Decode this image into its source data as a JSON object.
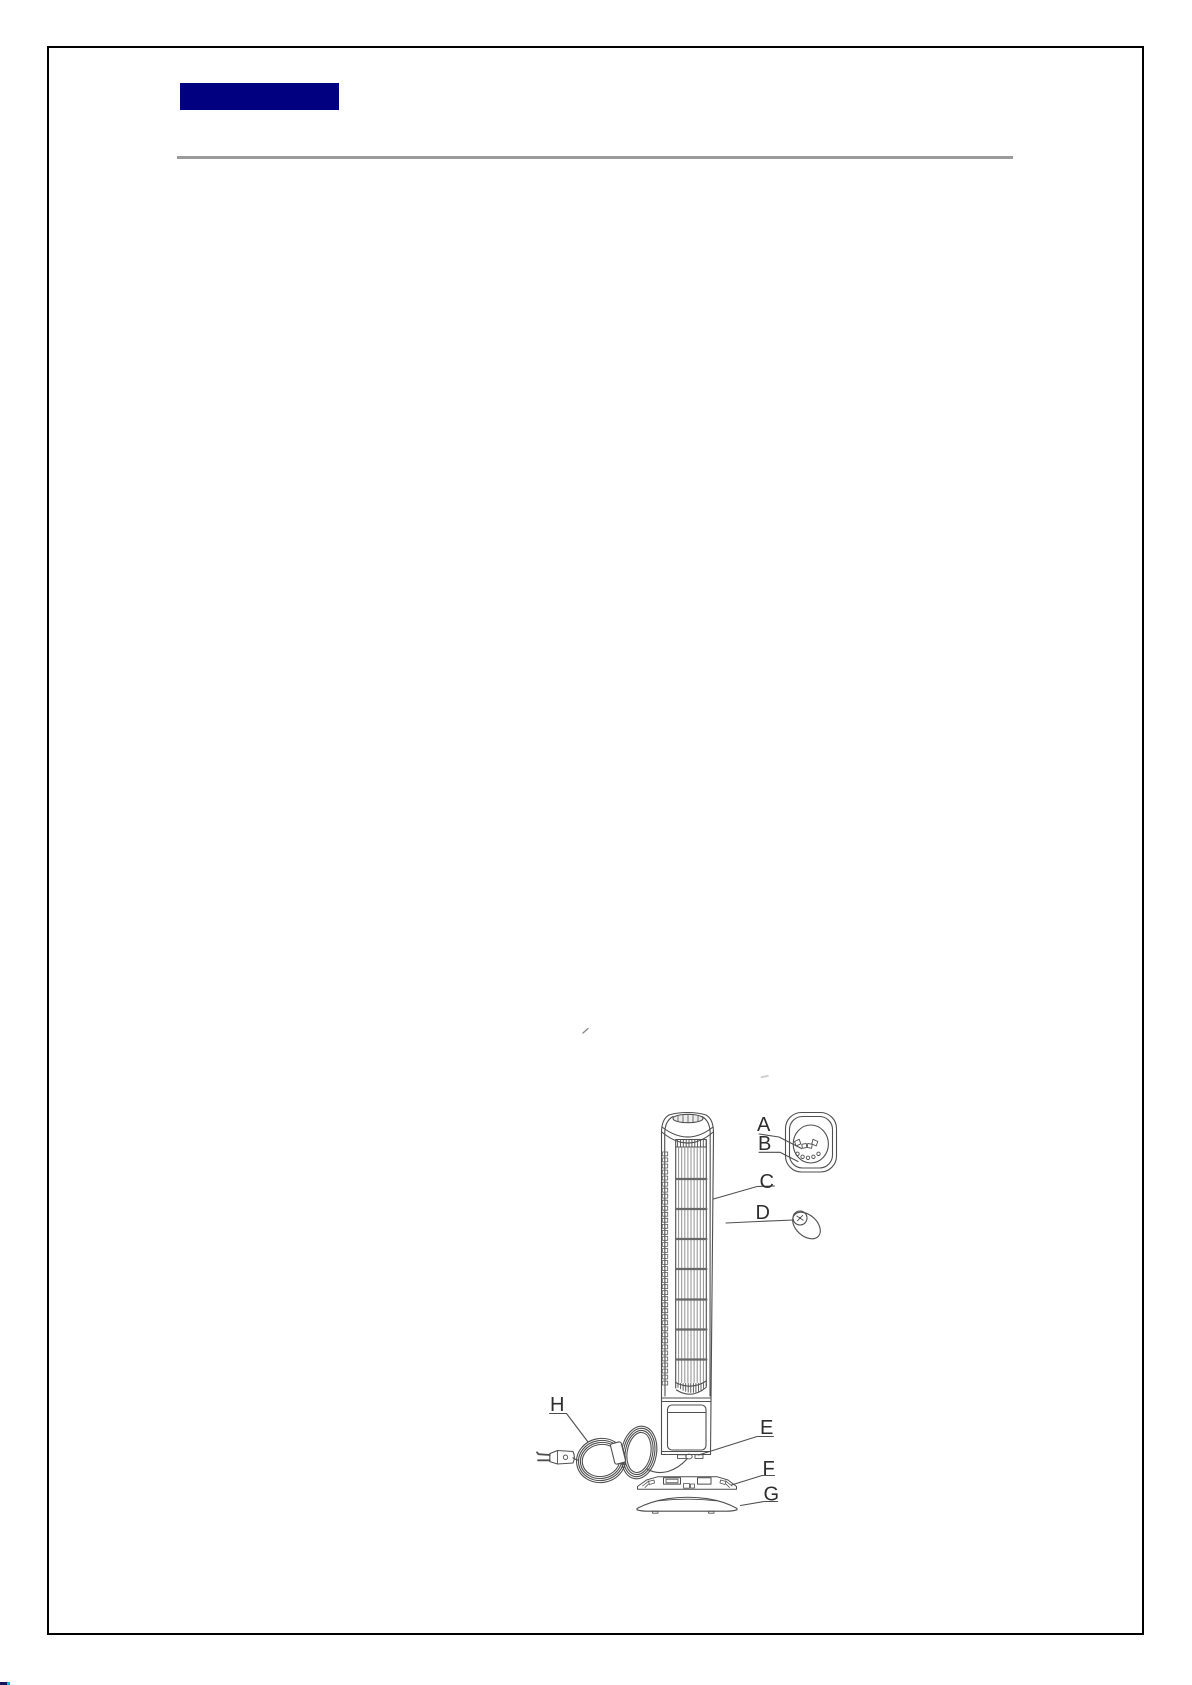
{
  "page": {
    "background_color": "#ffffff",
    "border_color": "#000000",
    "header_bar_color": "#000080",
    "divider_rule_color": "#9b9b9b",
    "edge_artifact_color": "#14145a",
    "edge_artifact_accent_color": "#00bcd4"
  },
  "diagram": {
    "figure": "tower-fan-parts-line-drawing",
    "stroke_color": "#4f4f4f",
    "labels": [
      "A",
      "B",
      "C",
      "D",
      "E",
      "F",
      "G",
      "H"
    ]
  }
}
